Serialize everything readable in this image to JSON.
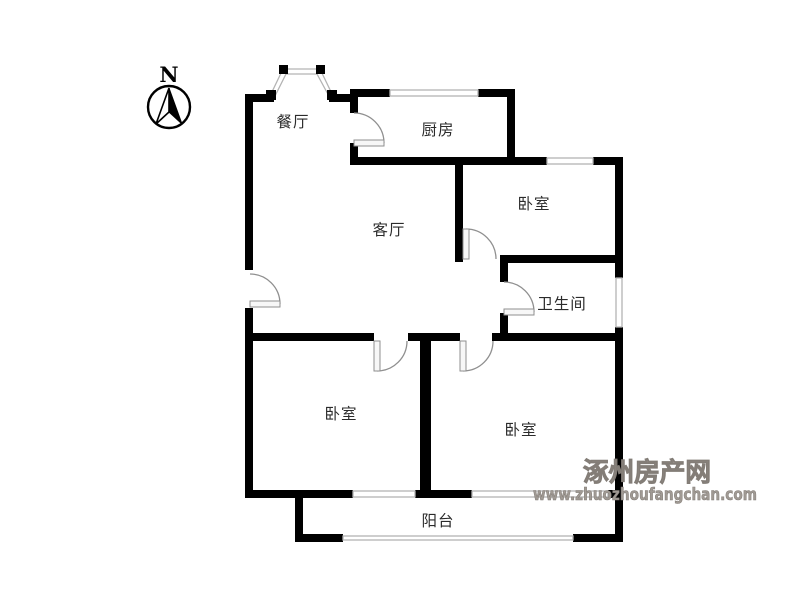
{
  "meta": {
    "type": "apartment-floor-plan",
    "canvas_width": 800,
    "canvas_height": 600,
    "background": "#ffffff"
  },
  "compass": {
    "label": "N"
  },
  "rooms": [
    {
      "id": "dining-room",
      "label": "餐厅"
    },
    {
      "id": "kitchen",
      "label": "厨房"
    },
    {
      "id": "bedroom-top-right",
      "label": "卧室"
    },
    {
      "id": "living-room",
      "label": "客厅"
    },
    {
      "id": "bathroom",
      "label": "卫生间"
    },
    {
      "id": "bedroom-bottom-left",
      "label": "卧室"
    },
    {
      "id": "bedroom-bottom-right",
      "label": "卧室"
    },
    {
      "id": "balcony",
      "label": "阳台"
    }
  ],
  "watermark": {
    "site_name": "涿州房产网",
    "site_url": "www.zhuozhoufangchan.com",
    "color": "#a09a94"
  },
  "colors": {
    "wall": "#000000",
    "window": "#b3b3b3",
    "door": "#8f8f8f",
    "label": "#2b2b2b",
    "background": "#ffffff"
  }
}
